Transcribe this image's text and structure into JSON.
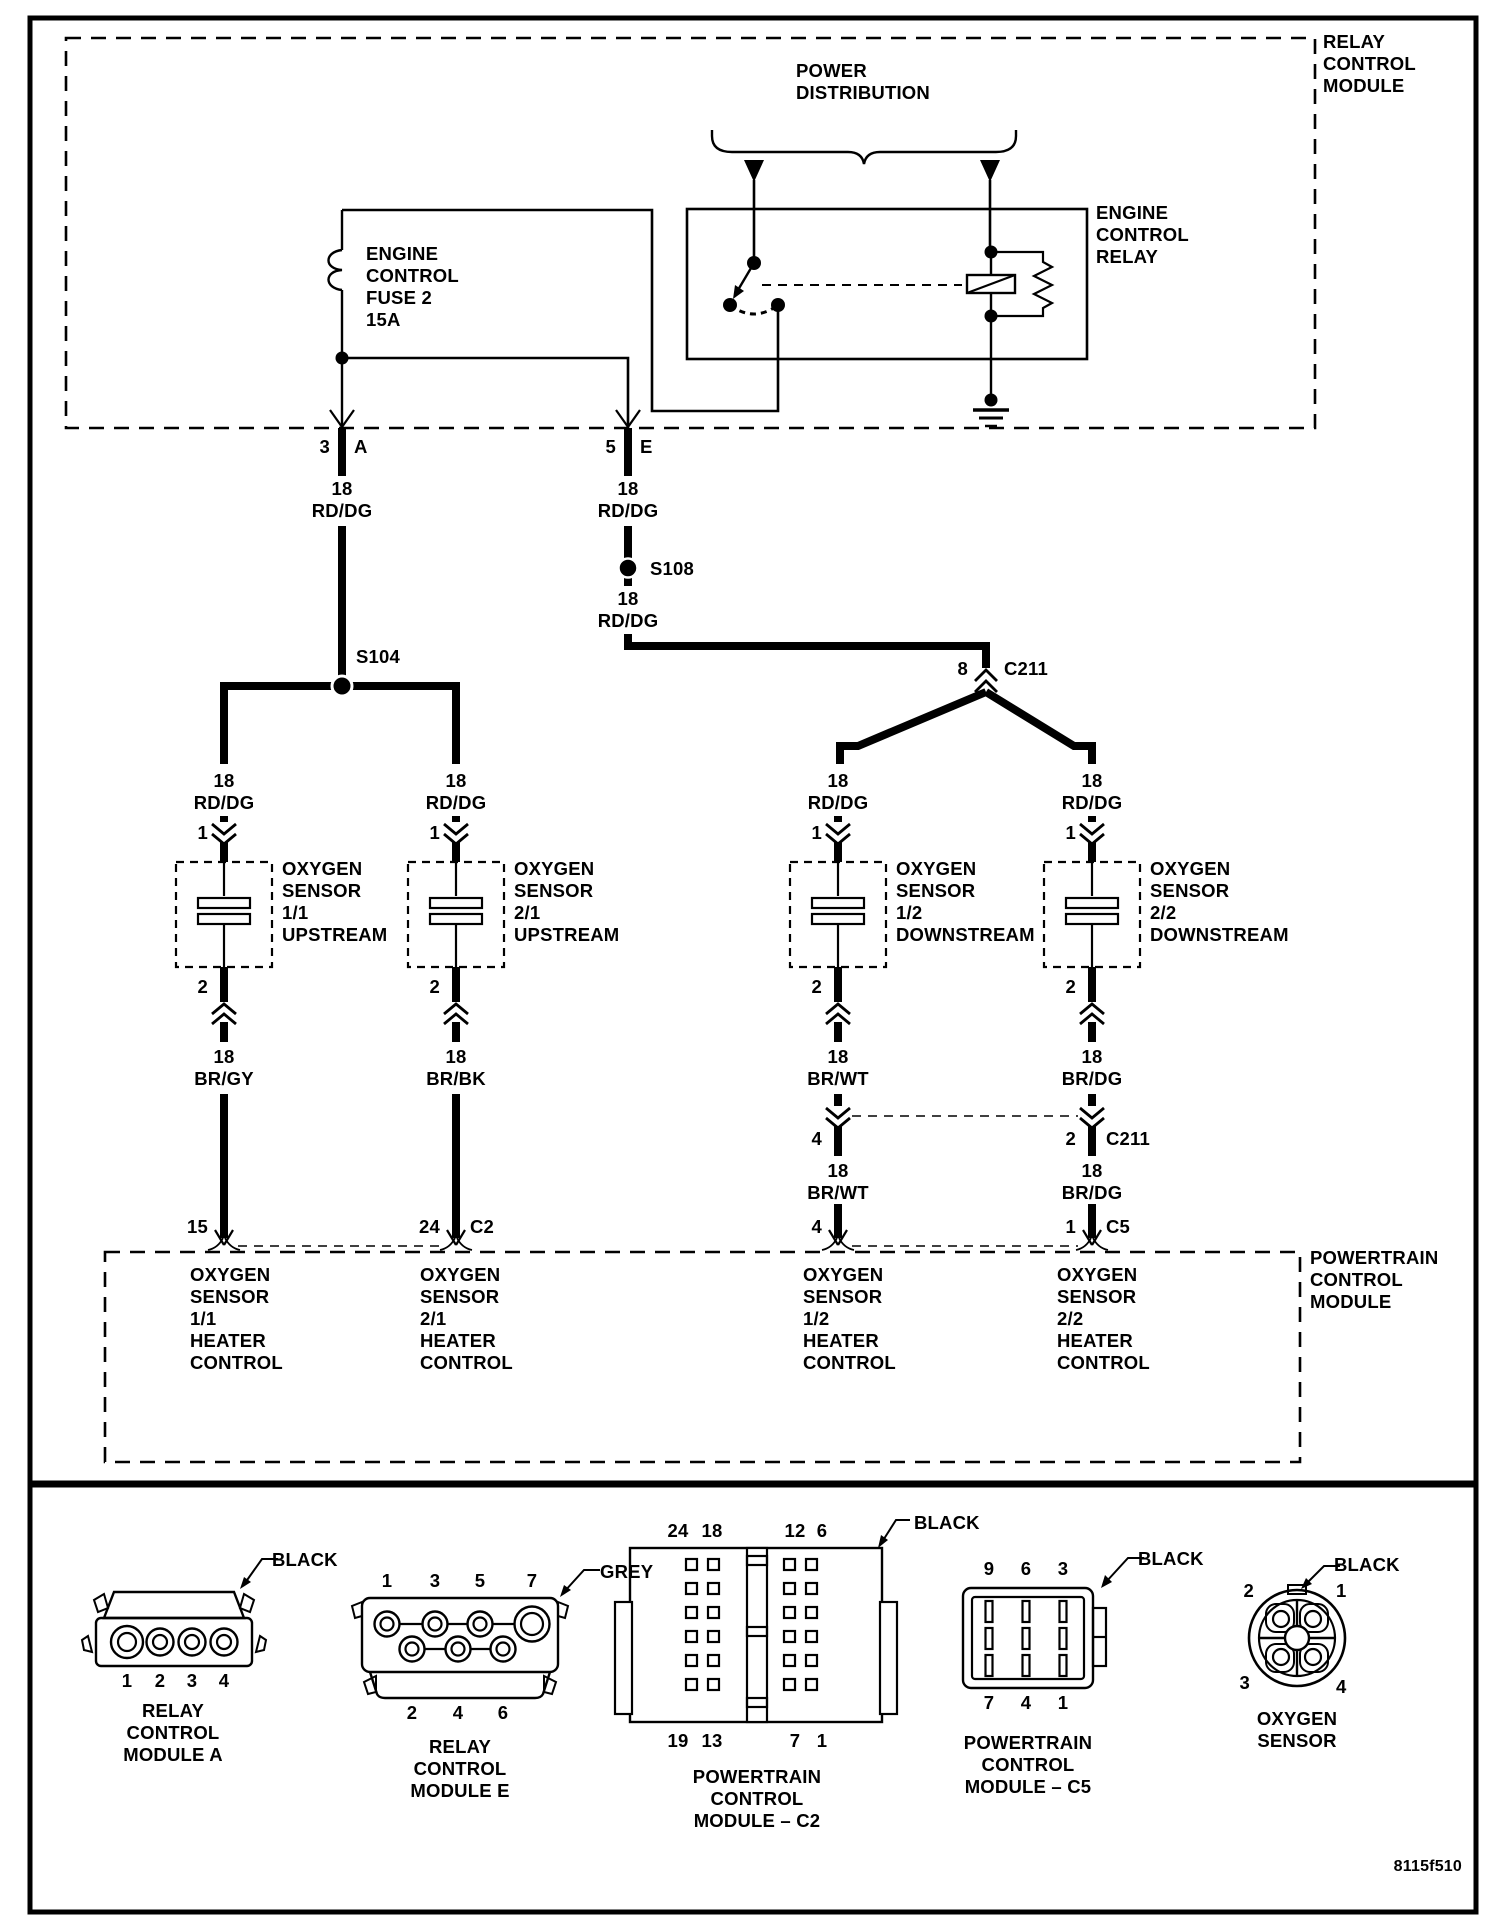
{
  "page": {
    "doc_id": "8115f510",
    "ink": "#000000",
    "paper": "#ffffff"
  },
  "relay_module": {
    "title": "RELAY\nCONTROL\nMODULE"
  },
  "power_distribution": "POWER\nDISTRIBUTION",
  "relay": {
    "name": "ENGINE\nCONTROL\nRELAY"
  },
  "fuse": "ENGINE\nCONTROL\nFUSE 2\n15A",
  "feed_pins": {
    "a_num": "3",
    "a": "A",
    "e_num": "5",
    "e": "E"
  },
  "splices": {
    "s104": "S104",
    "s108": "S108"
  },
  "c211": {
    "pin8": "8",
    "name": "C211",
    "pin4": "4",
    "pin2": "2",
    "name2": "C211"
  },
  "wires": {
    "rd_dg": "18\nRD/DG",
    "br_gy": "18\nBR/GY",
    "br_bk": "18\nBR/BK",
    "br_wt": "18\nBR/WT",
    "br_dg": "18\nBR/DG"
  },
  "sensors": {
    "pin_in": "1",
    "pin_out": "2",
    "s11": "OXYGEN\nSENSOR\n1/1\nUPSTREAM",
    "s21": "OXYGEN\nSENSOR\n2/1\nUPSTREAM",
    "s12": "OXYGEN\nSENSOR\n1/2\nDOWNSTREAM",
    "s22": "OXYGEN\nSENSOR\n2/2\nDOWNSTREAM"
  },
  "pcm": {
    "title": "POWERTRAIN\nCONTROL\nMODULE",
    "pin11": "15",
    "pin21": "24",
    "pin21_conn": "C2",
    "pin12": "4",
    "pin22": "1",
    "pin22_conn": "C5",
    "f11": "OXYGEN\nSENSOR\n1/1\nHEATER\nCONTROL",
    "f21": "OXYGEN\nSENSOR\n2/1\nHEATER\nCONTROL",
    "f12": "OXYGEN\nSENSOR\n1/2\nHEATER\nCONTROL",
    "f22": "OXYGEN\nSENSOR\n2/2\nHEATER\nCONTROL"
  },
  "connectors": {
    "rcm_a": {
      "caption": "RELAY\nCONTROL\nMODULE A",
      "color": "BLACK",
      "pins": [
        "1",
        "2",
        "3",
        "4"
      ]
    },
    "rcm_e": {
      "caption": "RELAY\nCONTROL\nMODULE E",
      "color": "GREY",
      "pins_top": [
        "1",
        "3",
        "5",
        "7"
      ],
      "pins_bottom": [
        "2",
        "4",
        "6"
      ]
    },
    "pcm_c2": {
      "caption": "POWERTRAIN\nCONTROL\nMODULE – C2",
      "color": "BLACK",
      "pins_top": [
        "24",
        "18",
        "12",
        "6"
      ],
      "pins_bottom": [
        "19",
        "13",
        "7",
        "1"
      ]
    },
    "pcm_c5": {
      "caption": "POWERTRAIN\nCONTROL\nMODULE – C5",
      "color": "BLACK",
      "pins_top": [
        "9",
        "6",
        "3"
      ],
      "pins_bottom": [
        "7",
        "4",
        "1"
      ]
    },
    "o2": {
      "caption": "OXYGEN\nSENSOR",
      "color": "BLACK",
      "pins": {
        "p2": "2",
        "p1": "1",
        "p3": "3",
        "p4": "4"
      }
    }
  }
}
